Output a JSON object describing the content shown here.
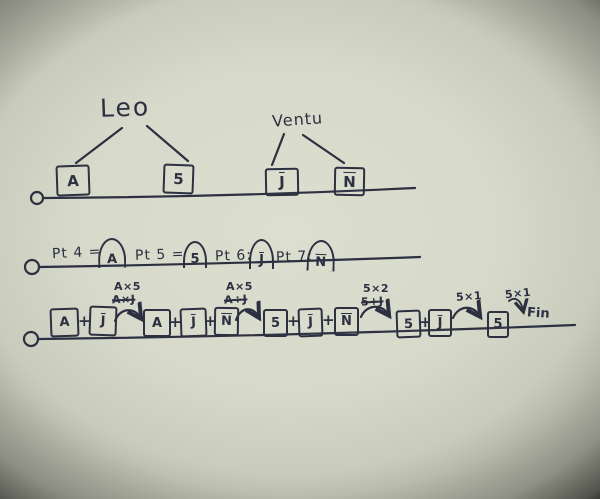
{
  "colors": {
    "paper": "#d7d9ca",
    "ink": "#2c3040"
  },
  "tree_left": {
    "title": "Leo",
    "child1": "A",
    "child2": "5"
  },
  "tree_right": {
    "title": "Ventu",
    "child1": "J",
    "child2": "N"
  },
  "points_row": {
    "p4_label": "Pt 4 =",
    "p4_value": "A",
    "p5_label": "Pt 5 =",
    "p5_value": "5",
    "p6_label": "Pt 6:",
    "p6_value": "J",
    "p7_label": "Pt 7:",
    "p7_value": "N"
  },
  "sequence": {
    "plus": "+",
    "g1": {
      "b1": "A",
      "b2": "J"
    },
    "g2": {
      "b1": "A",
      "b2": "J",
      "b3": "N"
    },
    "g3": {
      "b1": "5",
      "b2": "J",
      "b3": "N"
    },
    "g4": {
      "b1": "5",
      "b2": "J"
    },
    "g5": {
      "b1": "5"
    },
    "fin": "Fin"
  },
  "annotations": {
    "a1_top": "A×5",
    "a1_crossed": "A×J",
    "a2_top": "A×5",
    "a2_crossed": "A÷J",
    "a3_top": "5×2",
    "a3_crossed": "5+J",
    "a4_top": "5×1",
    "a5_top": "5×1"
  }
}
